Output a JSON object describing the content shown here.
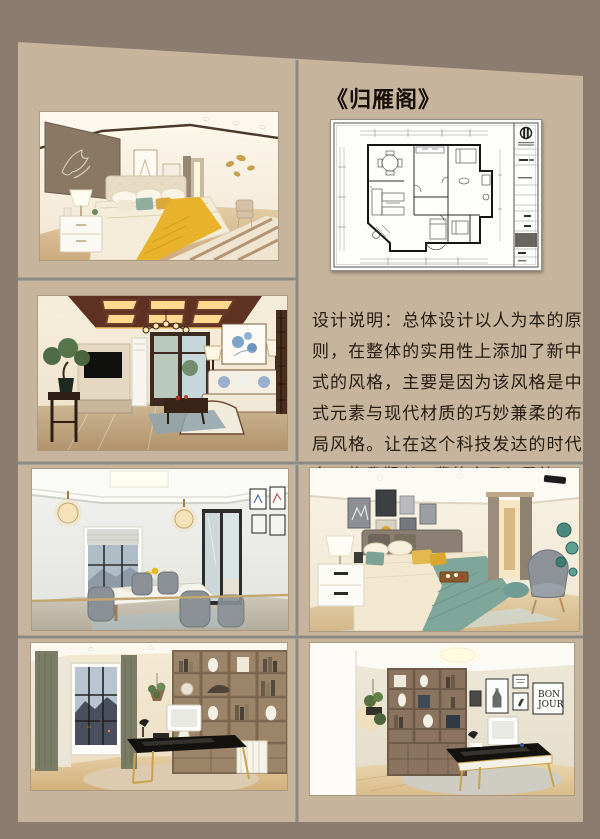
{
  "board": {
    "title": "《归雁阁》",
    "design_note": {
      "label": "设计说明：",
      "body": "总体设计以人为本的原则，在整体的实用性上添加了新中式的风格，主要是因为该风格是中式元素与现代材质的巧妙兼柔的布局风格。让在这个科技发达的时代多一些我们老一辈的家具与风格。"
    },
    "decor_text": {
      "bonjour_line1": "BON",
      "bonjour_line2": "JOUR"
    },
    "colors": {
      "frame": "#8c7b6f",
      "panel": "#c7b49d",
      "divider": "#7f7e76",
      "title_text": "#17100a",
      "note_text": "#241b11",
      "accent_yellow": "#e8b32b",
      "accent_teal": "#7fa69b"
    }
  }
}
